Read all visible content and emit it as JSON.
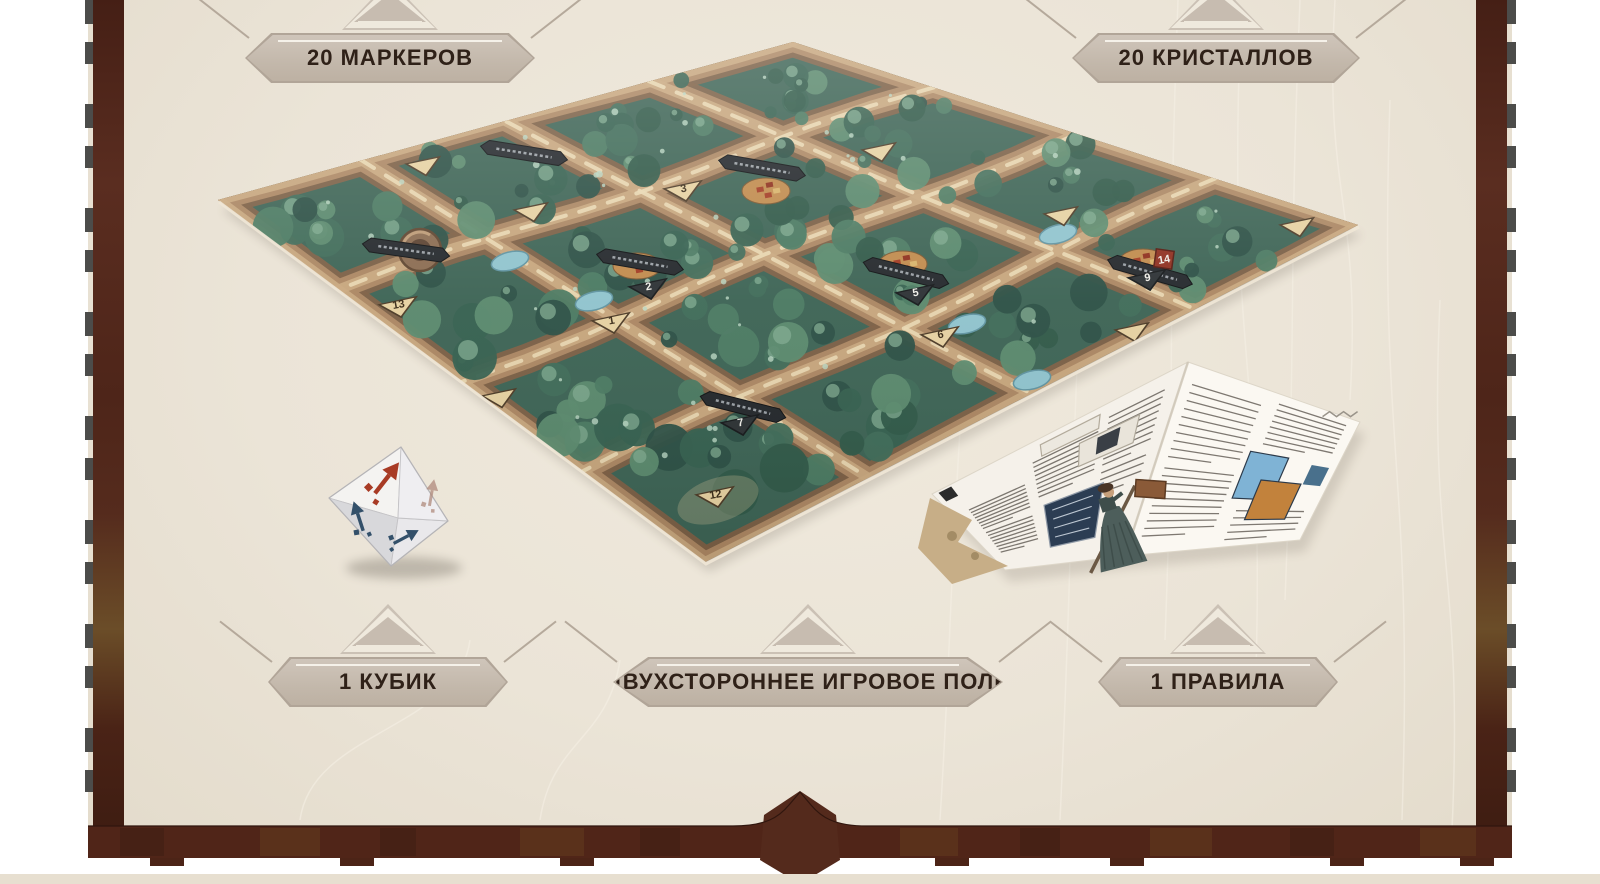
{
  "callouts": [
    {
      "id": "markers",
      "label": "20 МАРКЕРОВ",
      "position": "top-left"
    },
    {
      "id": "crystals",
      "label": "20 КРИСТАЛЛОВ",
      "position": "top-right"
    },
    {
      "id": "die",
      "label": "1 КУБИК",
      "position": "bottom-left"
    },
    {
      "id": "board",
      "label": "ДВУХСТОРОННЕЕ ИГРОВОЕ ПОЛЕ",
      "position": "bottom-center"
    },
    {
      "id": "rules",
      "label": "1 ПРАВИЛА",
      "position": "bottom-right"
    }
  ],
  "board": {
    "description_numbers_visible": [
      "1",
      "2",
      "3",
      "5",
      "6",
      "7",
      "9",
      "12",
      "13",
      "14"
    ],
    "numbered_markers": [
      {
        "num": "12",
        "x": 716,
        "y": 497,
        "style": "tan"
      },
      {
        "num": "7",
        "x": 741,
        "y": 425,
        "style": "dark"
      },
      {
        "num": "1",
        "x": 612,
        "y": 323,
        "style": "tan"
      },
      {
        "num": "13",
        "x": 399,
        "y": 307,
        "style": "tan"
      },
      {
        "num": "2",
        "x": 649,
        "y": 289,
        "style": "dark"
      },
      {
        "num": "3",
        "x": 684,
        "y": 191,
        "style": "tan"
      },
      {
        "num": "5",
        "x": 916,
        "y": 295,
        "style": "dark"
      },
      {
        "num": "6",
        "x": 941,
        "y": 337,
        "style": "tan"
      },
      {
        "num": "9",
        "x": 1148,
        "y": 280,
        "style": "dark"
      },
      {
        "num": "14",
        "x": 1164,
        "y": 259,
        "style": "red"
      }
    ],
    "plain_markers": [
      [
        424,
        166
      ],
      [
        532,
        212
      ],
      [
        1062,
        216
      ],
      [
        1298,
        227
      ],
      [
        880,
        152
      ],
      [
        1133,
        332
      ],
      [
        500,
        398
      ]
    ],
    "settlements": [
      {
        "x": 903,
        "y": 264
      },
      {
        "x": 1143,
        "y": 262
      },
      {
        "x": 766,
        "y": 191
      },
      {
        "x": 637,
        "y": 266
      },
      {
        "x": 420,
        "y": 250,
        "kind": "crater"
      }
    ],
    "lakes": [
      [
        510,
        261
      ],
      [
        594,
        301
      ],
      [
        967,
        324
      ],
      [
        1058,
        234
      ],
      [
        1032,
        380
      ]
    ],
    "ribbons": [
      {
        "x": 743,
        "y": 407,
        "rot": 14
      },
      {
        "x": 640,
        "y": 262,
        "rot": 10
      },
      {
        "x": 406,
        "y": 250,
        "rot": 8
      },
      {
        "x": 1150,
        "y": 272,
        "rot": 16
      },
      {
        "x": 906,
        "y": 273,
        "rot": 14
      },
      {
        "x": 762,
        "y": 168,
        "rot": 10
      },
      {
        "x": 524,
        "y": 153,
        "rot": 9
      }
    ]
  },
  "die": {
    "faces_visible": 4,
    "arrows": [
      {
        "face": "top",
        "color": "#a83b25"
      },
      {
        "face": "left",
        "color": "#33506a"
      },
      {
        "face": "bottom",
        "color": "#33506a"
      },
      {
        "face": "right",
        "color": "#b08a7c"
      }
    ]
  },
  "colors": {
    "parchment": "#ebe4d7",
    "border_brown": "#552a1d",
    "band_brown": "#502518",
    "banner_fill": "#c8bdb1",
    "banner_edge": "#b1a598",
    "banner_text": "#2f2118",
    "forest_dark": "#2b4f44",
    "forest_mid": "#3f6b58",
    "ridge_brown": "#ab8662",
    "path_cream": "#e9d8b2",
    "lake_blue": "#8fc3cd",
    "die_red": "#a83b25",
    "die_navy": "#33506a"
  }
}
